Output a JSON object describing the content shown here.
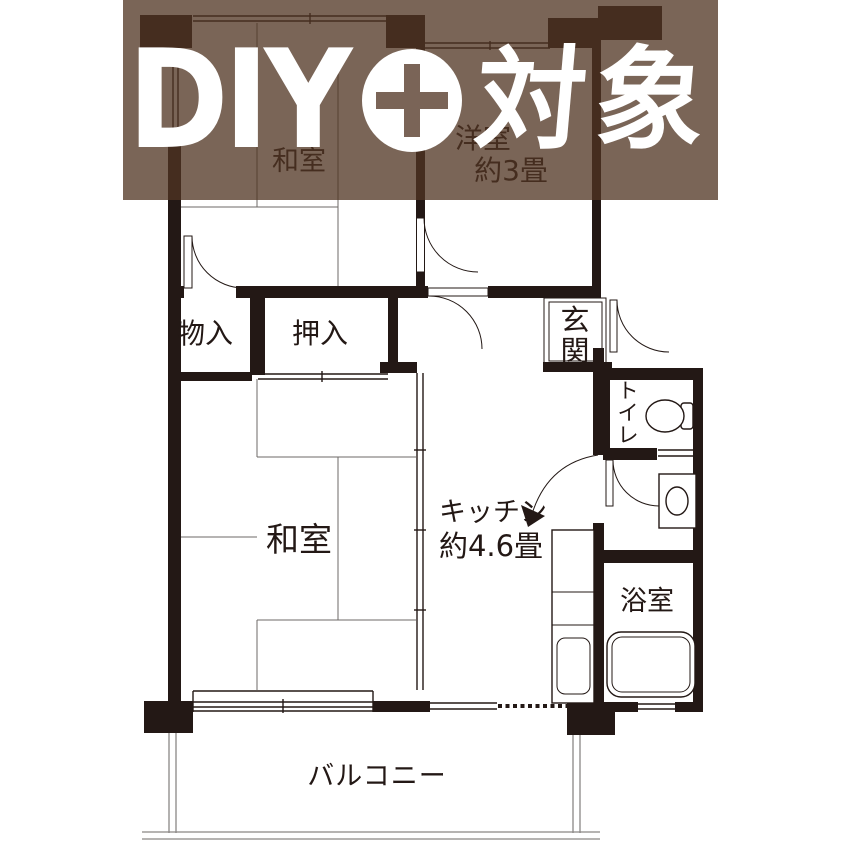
{
  "banner": {
    "diy": "DIY",
    "target": "対象"
  },
  "labels": {
    "washitsu_top": "和室",
    "yoshitsu_line1": "洋室",
    "yoshitsu_line2": "約3畳",
    "monoire": "物入",
    "oshiire": "押入",
    "genkan_1": "玄",
    "genkan_2": "関",
    "toilet_1": "ト",
    "toilet_2": "イ",
    "toilet_3": "レ",
    "washitsu_center": "和室",
    "kitchen_line1": "キッチン",
    "kitchen_line2": "約4.6畳",
    "bathroom": "浴室",
    "balcony": "バルコニー"
  },
  "colors": {
    "wall": "#231815",
    "banner_overlay": "rgba(80,52,34,0.76)",
    "banner_text": "#ffffff",
    "plus_cross": "#7a6457"
  }
}
